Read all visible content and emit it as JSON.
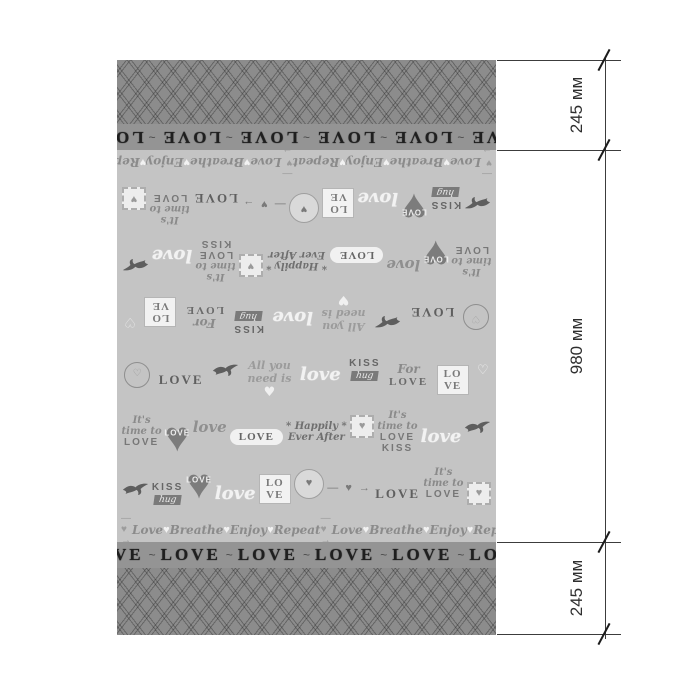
{
  "diagram": {
    "type": "product-dimension-diagram",
    "dimension_labels": [
      "245 мм",
      "980 мм",
      "245 мм"
    ],
    "total_height_mm": 1470
  },
  "fabric": {
    "love_band": {
      "word": "LOVE",
      "ornament": "~",
      "repeats": 6
    },
    "edge_row": {
      "sequence": [
        "— ♥ →",
        "Love",
        "♥",
        "Breathe",
        "♥",
        "Enjoy",
        "♥",
        "Repeat",
        "— ♥ →",
        "Love",
        "♥",
        "Breathe",
        "♥",
        "Enjoy",
        "♥",
        "Repeat"
      ]
    },
    "motif_rows": [
      [
        {
          "type": "badge",
          "text": "♡"
        },
        {
          "type": "caps",
          "text": "LOVE"
        },
        {
          "type": "bird"
        },
        {
          "type": "allyou",
          "text": "All you|need is|♥"
        },
        {
          "type": "scriptw",
          "text": "love"
        },
        {
          "type": "kiss",
          "text": "KISS|hug"
        },
        {
          "type": "forlove",
          "text": "For|LOVE"
        },
        {
          "type": "card",
          "text": "LO|VE"
        },
        {
          "type": "heartsm",
          "text": "♡"
        }
      ],
      [
        {
          "type": "timeto",
          "text": "It's|time to|LOVE"
        },
        {
          "type": "heart",
          "text": "LOVE"
        },
        {
          "type": "script",
          "text": "love"
        },
        {
          "type": "banner",
          "text": "LOVE"
        },
        {
          "type": "happily",
          "text": "* Happily *|Ever After"
        },
        {
          "type": "stamp",
          "text": "♥"
        },
        {
          "type": "timeto",
          "text": "It's|time to|LOVE|KISS"
        },
        {
          "type": "scriptw",
          "text": "love"
        },
        {
          "type": "bird"
        }
      ],
      [
        {
          "type": "bird"
        },
        {
          "type": "kiss",
          "text": "KISS|hug"
        },
        {
          "type": "heart",
          "text": "LOVE"
        },
        {
          "type": "scriptw",
          "text": "love"
        },
        {
          "type": "card",
          "text": "LO|VE"
        },
        {
          "type": "moon",
          "text": "♥"
        },
        {
          "type": "arrow",
          "text": "— ♥ →"
        },
        {
          "type": "caps",
          "text": "LOVE"
        },
        {
          "type": "timeto",
          "text": "It's|time to|LOVE"
        },
        {
          "type": "stamp",
          "text": "♥"
        }
      ]
    ],
    "colors": {
      "lattice_bg": "#8c8c8c",
      "band_bg": "#949494",
      "band_text": "#1f1f1f",
      "main_bg": "#c4c4c4",
      "motif_dark": "#6e6e6e",
      "motif_white": "#f2f2f2",
      "annotation": "#3c3c3c"
    }
  }
}
